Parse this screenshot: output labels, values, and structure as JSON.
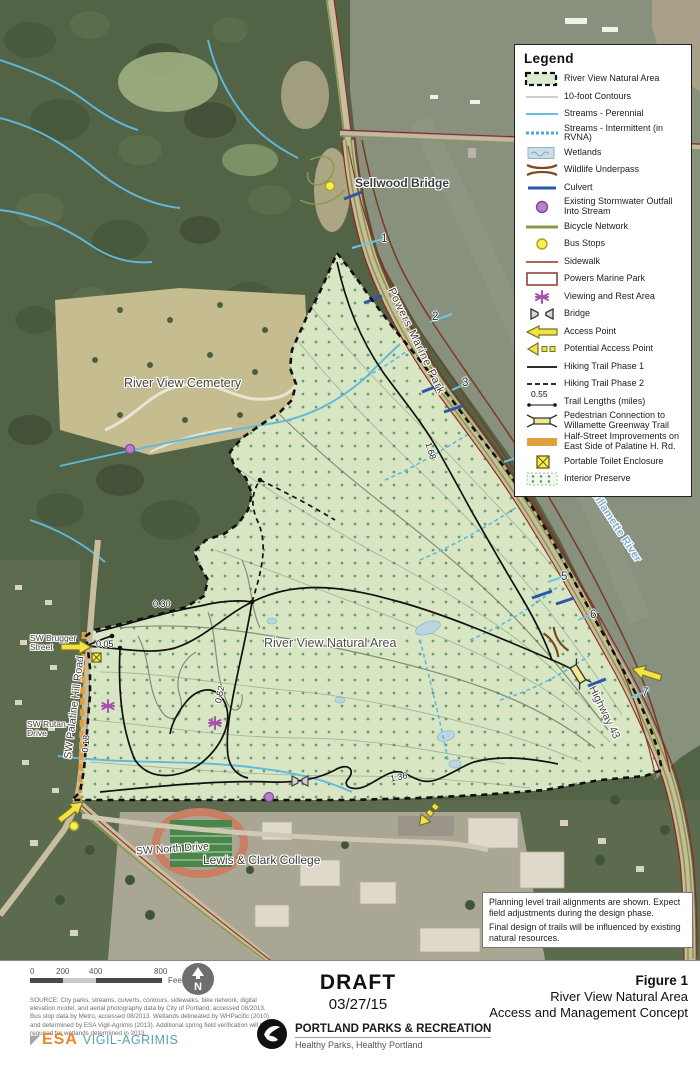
{
  "legend": {
    "title": "Legend",
    "items": [
      {
        "symbol": "rvna-swatch",
        "label": "River View Natural Area"
      },
      {
        "symbol": "contour",
        "label": "10-foot Contours"
      },
      {
        "symbol": "stream-perennial",
        "label": "Streams - Perennial"
      },
      {
        "symbol": "stream-intermittent",
        "label": "Streams - Intermittent (in RVNA)"
      },
      {
        "symbol": "wetlands",
        "label": "Wetlands"
      },
      {
        "symbol": "wildlife-underpass",
        "label": "Wildlife Underpass"
      },
      {
        "symbol": "culvert",
        "label": "Culvert"
      },
      {
        "symbol": "stormwater-outfall",
        "label": "Existing Stormwater Outfall Into Stream"
      },
      {
        "symbol": "bicycle-network",
        "label": "Bicycle Network"
      },
      {
        "symbol": "bus-stop",
        "label": "Bus Stops"
      },
      {
        "symbol": "sidewalk",
        "label": "Sidewalk"
      },
      {
        "symbol": "powers-marine-park",
        "label": "Powers Marine Park"
      },
      {
        "symbol": "viewing-rest-area",
        "label": "Viewing and Rest Area"
      },
      {
        "symbol": "bridge",
        "label": "Bridge"
      },
      {
        "symbol": "access-point",
        "label": "Access Point"
      },
      {
        "symbol": "potential-access-point",
        "label": "Potential Access Point"
      },
      {
        "symbol": "hiking-trail-phase-1",
        "label": "Hiking Trail Phase 1"
      },
      {
        "symbol": "hiking-trail-phase-2",
        "label": "Hiking Trail Phase 2"
      },
      {
        "symbol": "trail-length",
        "value": "0.55",
        "label": "Trail Lengths (miles)"
      },
      {
        "symbol": "pedestrian-connection",
        "label": "Pedestrian Connection to Willamette Greenway Trail"
      },
      {
        "symbol": "half-street",
        "label": "Half-Street Improvements on East Side of Palatine H. Rd."
      },
      {
        "symbol": "portable-toilet",
        "label": "Portable Toilet Enclosure"
      },
      {
        "symbol": "interior-preserve",
        "label": "Interior Preserve"
      }
    ]
  },
  "map": {
    "labels": {
      "sellwood_bridge": "Sellwood Bridge",
      "river_view_cemetery": "River View Cemetery",
      "natural_area": "River View Natural Area",
      "powers_marine_park": "Powers Marine Park",
      "willamette_river": "Willamette River",
      "highway_43": "Highway 43",
      "palatine_hill_road": "SW Palatine Hill Road",
      "brugger_street": "SW Brugger Street",
      "rutan_drive": "SW Rutan Drive",
      "north_drive": "SW North Drive",
      "lewis_clark": "Lewis & Clark College"
    },
    "trail_lengths": {
      "t005": "0.05",
      "t018": "0.18",
      "t030": "0.30",
      "t052": "0.52",
      "t136": "1.36",
      "t168": "1.68"
    },
    "river_points": [
      "1",
      "2",
      "3",
      "4",
      "5",
      "6",
      "7"
    ],
    "note": {
      "line1": "Planning level trail alignments are shown. Expect field adjustments during the design phase.",
      "line2": "Final design of trails will be influenced by existing natural resources."
    }
  },
  "footer": {
    "scale": {
      "ticks": [
        "0",
        "200",
        "400",
        "800"
      ],
      "unit": "Feet"
    },
    "north_label": "N",
    "source": "SOURCE: City parks, streams, culverts, contours, sidewalks, bike network, digital elevation model, and aerial photography data by City of Portland, accessed 08/2013. Bus stop data by Metro, accessed 08/2013. Wetlands delineated by WHPacific (2010) and determined by ESA Vigil-Agrimis (2013). Additional spring field verification will be required for wetlands determined in 2013.",
    "esa": {
      "name": "ESA",
      "sub": "VIGIL-AGRIMIS"
    },
    "draft": {
      "label": "DRAFT",
      "date": "03/27/15"
    },
    "agency": {
      "name": "PORTLAND PARKS & RECREATION",
      "tagline": "Healthy Parks, Healthy Portland"
    },
    "figure": {
      "number": "Figure 1",
      "line1": "River View Natural Area",
      "line2": "Access and Management Concept"
    }
  },
  "colors": {
    "river": "#87917e",
    "natural_area": "#d8e6c4",
    "forest": "#536446",
    "access_yellow": "#f2e243",
    "stormwater_outfall": "#b77fc9",
    "half_street": "#dfa03e",
    "boundary": "#111111",
    "stream": "#5fb8de",
    "bicycle": "#8a9a4a",
    "sidewalk": "#8f2a20",
    "powers_boundary": "#7a3a22",
    "bus_stop": "#f7ef4a"
  }
}
